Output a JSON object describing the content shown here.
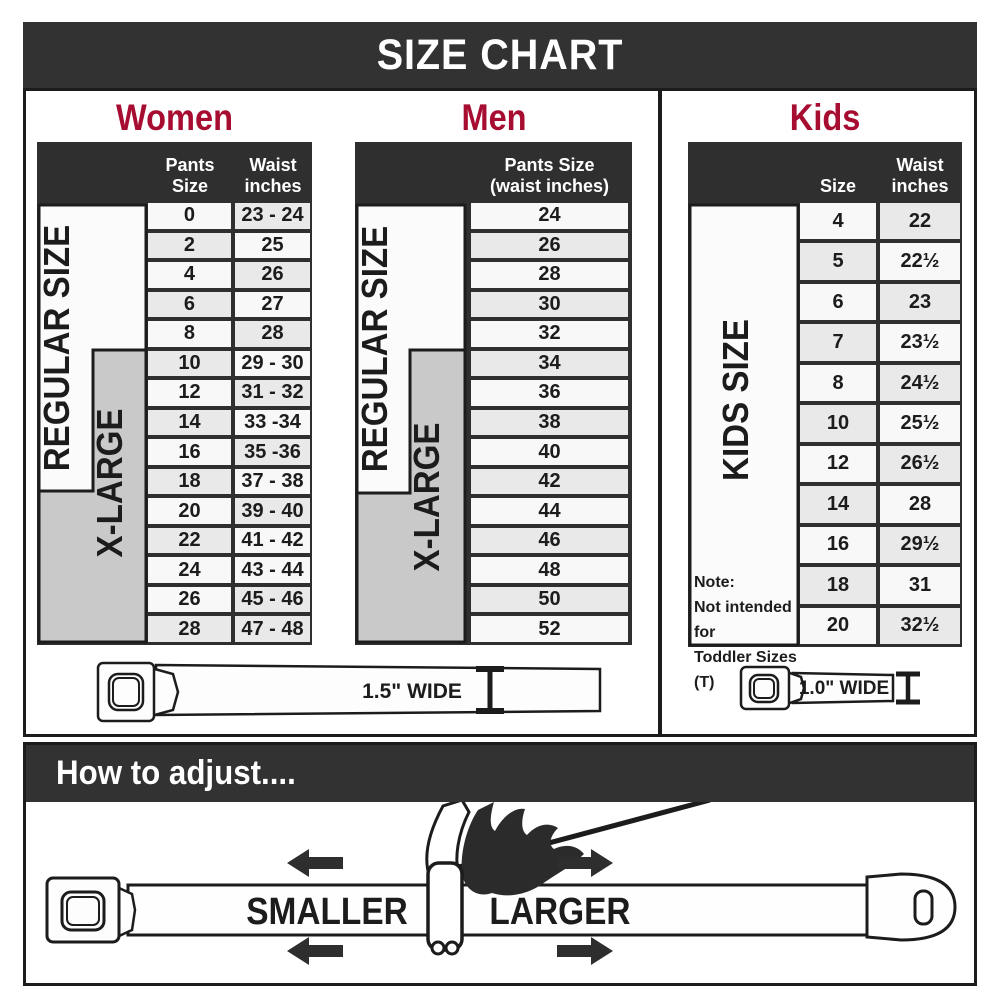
{
  "title": "SIZE CHART",
  "colors": {
    "accent_red": "#A60D31",
    "bar_dark": "#323232",
    "grid_dark": "#2f2f2f",
    "row_light": "#f8f8f8",
    "row_shaded": "#e9e9e9",
    "xlarge_gray": "#c9c9c9"
  },
  "women": {
    "heading": "Women",
    "col1_header": "Pants Size",
    "col2_header_line1": "Waist",
    "col2_header_line2": "inches",
    "regular_label": "REGULAR SIZE",
    "xlarge_label": "X-LARGE",
    "rows": [
      {
        "size": "0",
        "waist": "23 - 24"
      },
      {
        "size": "2",
        "waist": "25"
      },
      {
        "size": "4",
        "waist": "26"
      },
      {
        "size": "6",
        "waist": "27"
      },
      {
        "size": "8",
        "waist": "28"
      },
      {
        "size": "10",
        "waist": "29 - 30"
      },
      {
        "size": "12",
        "waist": "31 - 32"
      },
      {
        "size": "14",
        "waist": "33 -34"
      },
      {
        "size": "16",
        "waist": "35 -36"
      },
      {
        "size": "18",
        "waist": "37 - 38"
      },
      {
        "size": "20",
        "waist": "39 - 40"
      },
      {
        "size": "22",
        "waist": "41 - 42"
      },
      {
        "size": "24",
        "waist": "43 - 44"
      },
      {
        "size": "26",
        "waist": "45 - 46"
      },
      {
        "size": "28",
        "waist": "47 - 48"
      }
    ]
  },
  "men": {
    "heading": "Men",
    "col_header_line1": "Pants Size",
    "col_header_line2": "(waist inches)",
    "regular_label": "REGULAR SIZE",
    "xlarge_label": "X-LARGE",
    "rows": [
      "24",
      "26",
      "28",
      "30",
      "32",
      "34",
      "36",
      "38",
      "40",
      "42",
      "44",
      "46",
      "48",
      "50",
      "52"
    ]
  },
  "kids": {
    "heading": "Kids",
    "col1_header": "Size",
    "col2_header_line1": "Waist",
    "col2_header_line2": "inches",
    "label": "KIDS SIZE",
    "note_line1": "Note:",
    "note_line2": "Not intended for",
    "note_line3": "Toddler Sizes (T)",
    "rows": [
      {
        "size": "4",
        "waist": "22"
      },
      {
        "size": "5",
        "waist": "22½"
      },
      {
        "size": "6",
        "waist": "23"
      },
      {
        "size": "7",
        "waist": "23½"
      },
      {
        "size": "8",
        "waist": "24½"
      },
      {
        "size": "10",
        "waist": "25½"
      },
      {
        "size": "12",
        "waist": "26½"
      },
      {
        "size": "14",
        "waist": "28"
      },
      {
        "size": "16",
        "waist": "29½"
      },
      {
        "size": "18",
        "waist": "31"
      },
      {
        "size": "20",
        "waist": "32½"
      }
    ]
  },
  "belts": {
    "adult_width_label": "1.5\" WIDE",
    "kids_width_label": "1.0\" WIDE"
  },
  "adjust": {
    "heading": "How to adjust....",
    "smaller_label": "SMALLER",
    "larger_label": "LARGER"
  }
}
